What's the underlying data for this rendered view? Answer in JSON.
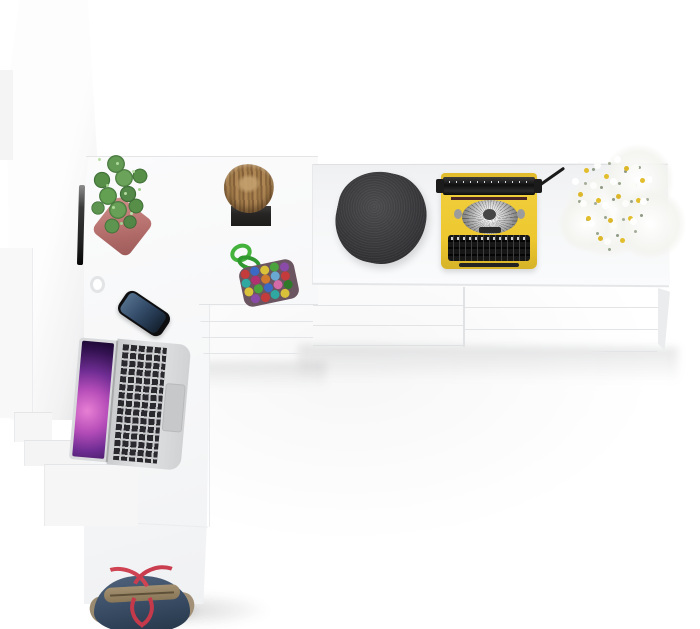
{
  "meta": {
    "type": "3d-product-render",
    "view": "top-down",
    "description": "Top view of a white L-shaped desk workstation with hutch panel and drawer sideboard, decorated with desk objects",
    "text_content": "none"
  },
  "palette": {
    "background": "#ffffff",
    "furniture_white": "#f7f8f9",
    "edge_gray": "#e3e4e6",
    "accent_yellow": "#f0ce3a",
    "pot_pink": "#b56f6c",
    "plant_green": "#578f49",
    "cord_green": "#43b33c",
    "pouf_charcoal": "#353538",
    "wood_brown": "#a07a49",
    "bag_denim": "#3c4f68",
    "bag_tan": "#9a8a70",
    "strap_red": "#cf4352",
    "laptop_silver": "#d9dadc",
    "screen_purple": "#b44cb8",
    "phone_screen_blue": "#3a5371",
    "flower_yellow": "#e2bd2c"
  },
  "scene": {
    "objects": [
      {
        "id": "hutch-panel",
        "label": "Tall white hutch side panel (top view)"
      },
      {
        "id": "monitor-edge",
        "label": "Dark monitor edge seen from above"
      },
      {
        "id": "desk-surface",
        "label": "White L-shaped desk surface"
      },
      {
        "id": "sideboard-top",
        "label": "White sideboard top surface"
      },
      {
        "id": "drawer-unit-left",
        "label": "White drawer unit under desk"
      },
      {
        "id": "drawer-unit-mid",
        "label": "White sideboard drawer unit (middle)"
      },
      {
        "id": "drawer-unit-right",
        "label": "White sideboard drawer unit (right)"
      },
      {
        "id": "potted-cactus",
        "label": "Green cactus plant in pink square pot"
      },
      {
        "id": "log-stool",
        "label": "Natural wood log stool on black base"
      },
      {
        "id": "pompom-trivet",
        "label": "Multicolor pom-pom trivet with green cord loop"
      },
      {
        "id": "knitted-pouf",
        "label": "Charcoal knitted pouf seat"
      },
      {
        "id": "typewriter",
        "label": "Vintage yellow typewriter with black keys"
      },
      {
        "id": "flower-bouquet",
        "label": "White flower bouquet with yellow centers"
      },
      {
        "id": "laptop",
        "label": "Silver laptop open with purple nebula wallpaper"
      },
      {
        "id": "smartphone",
        "label": "Black smartphone with blue lock screen"
      },
      {
        "id": "cable-hook",
        "label": "Small white cable hook on desk edge"
      },
      {
        "id": "handbag",
        "label": "Denim-blue handbag with tan trim and red straps"
      }
    ]
  }
}
